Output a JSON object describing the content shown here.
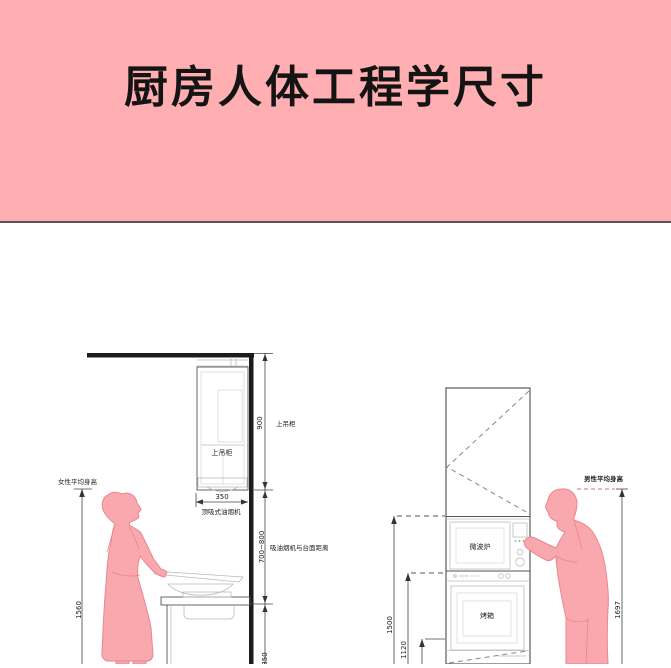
{
  "header": {
    "title": "厨房人体工程学尺寸"
  },
  "colors": {
    "banner_pink": "#ffafb2",
    "figure_fill": "#f9a9ad",
    "figure_outline": "#ea8590",
    "structure_black": "#1c1c1c",
    "dimension_line": "#444444",
    "accent_dashed_pink": "#e8838d"
  },
  "left": {
    "cabinet_label": "上吊柜",
    "hood_width": "350",
    "hood_name": "顶吸式油烟机",
    "dim_cabinet_value": "900",
    "dim_cabinet_label": "上吊柜",
    "dim_hood_value": "700~800",
    "dim_hood_label": "吸油烟机与台面距离",
    "dim_counter_value": "850",
    "dim_female_value": "1560",
    "dim_female_label": "女性平均身高"
  },
  "right": {
    "microwave_label": "微波炉",
    "oven_label": "烤箱",
    "dim_1500": "1500",
    "dim_1120": "1120",
    "dim_male_value": "1697",
    "dim_male_label": "男性平均身高"
  }
}
